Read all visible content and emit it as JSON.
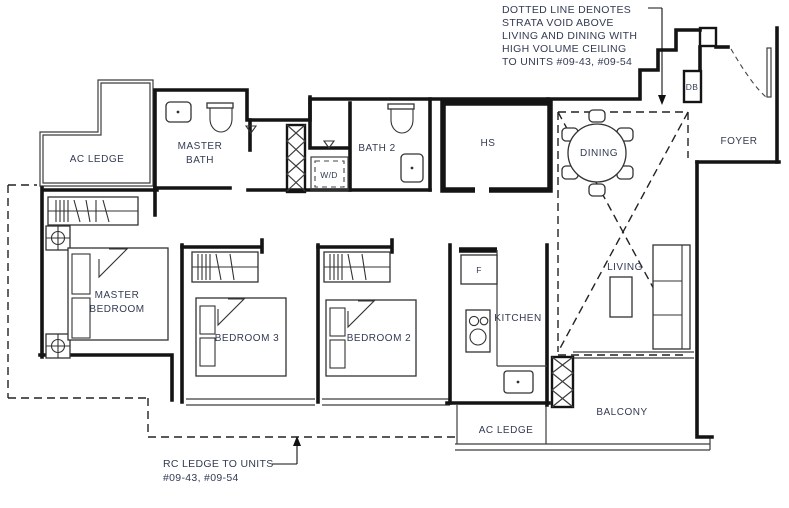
{
  "annotations": {
    "strata_void_note": {
      "lines": [
        "DOTTED LINE DENOTES",
        "STRATA VOID ABOVE",
        "LIVING AND DINING WITH",
        "HIGH VOLUME CEILING",
        "TO UNITS #09-43, #09-54"
      ]
    },
    "rc_ledge_note": {
      "lines": [
        "RC LEDGE TO UNITS",
        "#09-43, #09-54"
      ]
    }
  },
  "rooms": {
    "ac_ledge_top": "AC LEDGE",
    "master_bath": {
      "line1": "MASTER",
      "line2": "BATH"
    },
    "wd": "W/D",
    "bath2": "BATH 2",
    "hs": "HS",
    "db": "DB",
    "foyer": "FOYER",
    "dining": "DINING",
    "master_bedroom": {
      "line1": "MASTER",
      "line2": "BEDROOM"
    },
    "bedroom3": "BEDROOM 3",
    "bedroom2": "BEDROOM 2",
    "fridge": "F",
    "kitchen": "KITCHEN",
    "living": "LIVING",
    "balcony": "BALCONY",
    "ac_ledge_bottom": "AC LEDGE"
  },
  "colors": {
    "line": "#141414",
    "thin": "#3c3c3c",
    "label": "#333b52",
    "bg": "#ffffff"
  }
}
